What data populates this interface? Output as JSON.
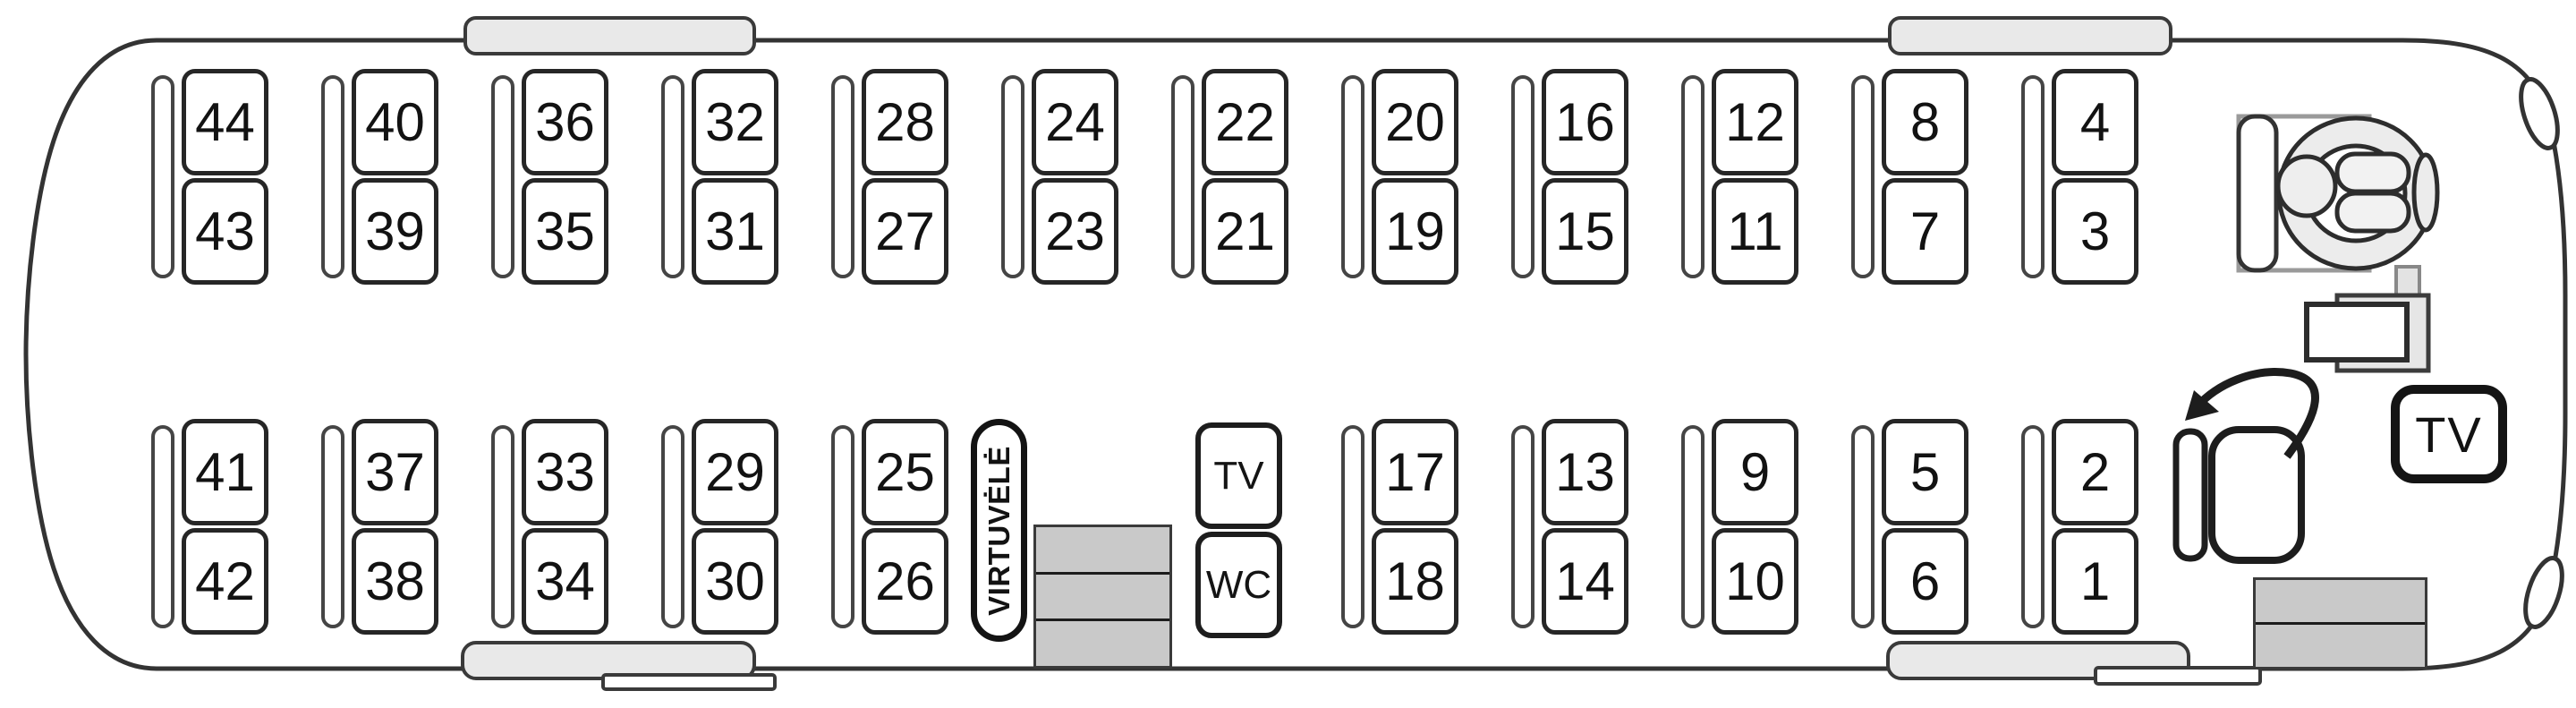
{
  "bus": {
    "seats": {
      "top_row": [
        {
          "upper": "44",
          "lower": "43"
        },
        {
          "upper": "40",
          "lower": "39"
        },
        {
          "upper": "36",
          "lower": "35"
        },
        {
          "upper": "32",
          "lower": "31"
        },
        {
          "upper": "28",
          "lower": "27"
        },
        {
          "upper": "24",
          "lower": "23"
        },
        {
          "upper": "22",
          "lower": "21"
        },
        {
          "upper": "20",
          "lower": "19"
        },
        {
          "upper": "16",
          "lower": "15"
        },
        {
          "upper": "12",
          "lower": "11"
        },
        {
          "upper": "8",
          "lower": "7"
        },
        {
          "upper": "4",
          "lower": "3"
        }
      ],
      "bottom_rear": [
        {
          "upper": "41",
          "lower": "42"
        },
        {
          "upper": "37",
          "lower": "38"
        },
        {
          "upper": "33",
          "lower": "34"
        },
        {
          "upper": "29",
          "lower": "30"
        },
        {
          "upper": "25",
          "lower": "26"
        }
      ],
      "bottom_front": [
        {
          "upper": "17",
          "lower": "18"
        },
        {
          "upper": "13",
          "lower": "14"
        },
        {
          "upper": "9",
          "lower": "10"
        },
        {
          "upper": "5",
          "lower": "6"
        },
        {
          "upper": "2",
          "lower": "1"
        }
      ]
    },
    "rooms": {
      "kitchen": "VIRTUVĖLĖ",
      "tv": "TV",
      "wc": "WC"
    },
    "front_tv": "TV",
    "icons": {
      "driver": "driver-seat-with-steering-wheel-icon",
      "guide_seat": "rotating-guide-seat-icon",
      "rotate_arrow": "rotate-arrow-icon",
      "mid_stairs": "middle-door-steps-icon",
      "front_stairs": "front-door-steps-icon",
      "roof_hatch": "roof-hatch-icon",
      "door_bump": "open-door-icon",
      "mirror": "exterior-mirror-icon"
    },
    "colors": {
      "line": "#333333",
      "hatch_fill": "#e9e9e9",
      "stairs_fill": "#c9c9c9",
      "wheel_fill": "#ececec"
    }
  }
}
